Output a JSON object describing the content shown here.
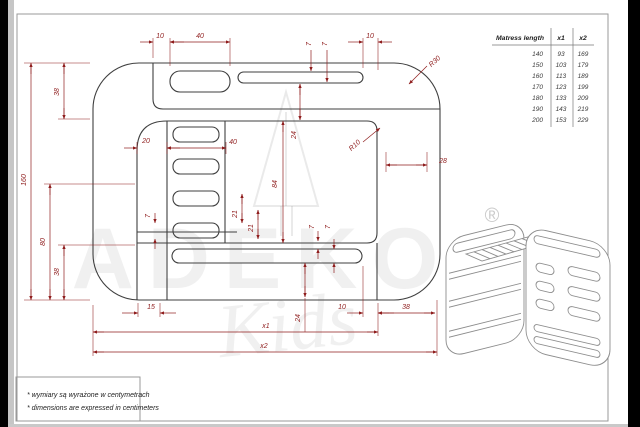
{
  "colors": {
    "dim": "#8f1d1d",
    "line": "#3f3f3f",
    "frame": "#999999",
    "paper": "#ffffff"
  },
  "table": {
    "headers": [
      "Matress length",
      "x1",
      "x2"
    ],
    "rows": [
      [
        "140",
        "93",
        "169"
      ],
      [
        "150",
        "103",
        "179"
      ],
      [
        "160",
        "113",
        "189"
      ],
      [
        "170",
        "123",
        "199"
      ],
      [
        "180",
        "133",
        "209"
      ],
      [
        "190",
        "143",
        "219"
      ],
      [
        "200",
        "153",
        "229"
      ]
    ]
  },
  "notes": {
    "line1": "* wymiary są wyrażone w centymetrach",
    "line2": "* dimensions are expressed in centimeters"
  },
  "watermark": {
    "brand": "ADEKO",
    "sub": "Kids",
    "registered": "®"
  },
  "dimensions": [
    {
      "label": "10",
      "x": 160,
      "y": 38
    },
    {
      "label": "40",
      "x": 200,
      "y": 38
    },
    {
      "label": "7",
      "x": 311,
      "y": 44,
      "rot": -90
    },
    {
      "label": "7",
      "x": 327,
      "y": 44,
      "rot": -90
    },
    {
      "label": "10",
      "x": 370,
      "y": 38
    },
    {
      "label": "R30",
      "x": 436,
      "y": 63,
      "rot": -42
    },
    {
      "label": "160",
      "x": 26,
      "y": 180,
      "rot": -90
    },
    {
      "label": "38",
      "x": 59,
      "y": 92,
      "rot": -90
    },
    {
      "label": "80",
      "x": 45,
      "y": 242,
      "rot": -90
    },
    {
      "label": "38",
      "x": 59,
      "y": 272,
      "rot": -90
    },
    {
      "label": "20",
      "x": 146,
      "y": 143
    },
    {
      "label": "40",
      "x": 233,
      "y": 144
    },
    {
      "label": "84",
      "x": 277,
      "y": 184,
      "rot": -90
    },
    {
      "label": "24",
      "x": 296,
      "y": 135,
      "rot": -90
    },
    {
      "label": "21",
      "x": 237,
      "y": 214,
      "rot": -90
    },
    {
      "label": "21",
      "x": 253,
      "y": 228,
      "rot": -90
    },
    {
      "label": "7",
      "x": 150,
      "y": 216,
      "rot": -90
    },
    {
      "label": "7",
      "x": 314,
      "y": 227,
      "rot": -90
    },
    {
      "label": "7",
      "x": 330,
      "y": 227,
      "rot": -90
    },
    {
      "label": "R10",
      "x": 356,
      "y": 147,
      "rot": -42
    },
    {
      "label": "28",
      "x": 443,
      "y": 163
    },
    {
      "label": "15",
      "x": 151,
      "y": 309
    },
    {
      "label": "24",
      "x": 300,
      "y": 318,
      "rot": -90
    },
    {
      "label": "10",
      "x": 342,
      "y": 309
    },
    {
      "label": "38",
      "x": 406,
      "y": 309
    },
    {
      "label": "x1",
      "x": 266,
      "y": 328
    },
    {
      "label": "x2",
      "x": 264,
      "y": 348
    }
  ]
}
